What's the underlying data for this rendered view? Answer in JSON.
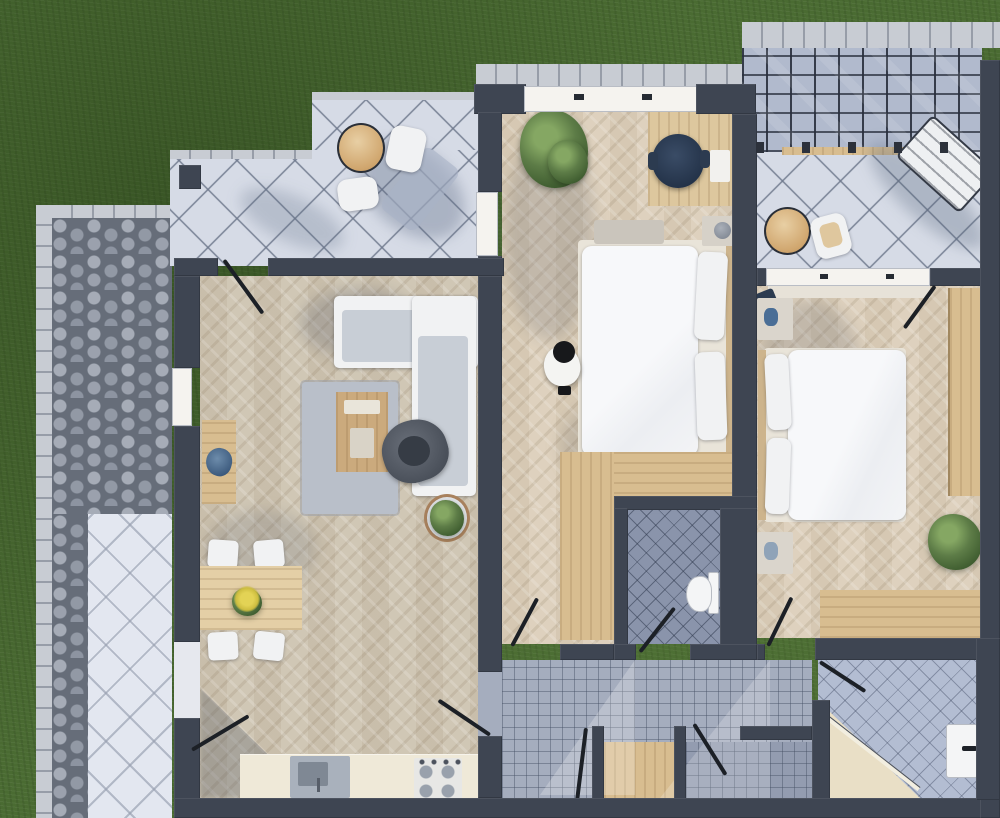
{
  "meta": {
    "description": "3D top-down architectural floor plan rendering of an apartment with garden lawn, paver walkway, three tiled terraces, a pergola canopy and furnished rooms",
    "width_px": 1000,
    "height_px": 818,
    "visible_text": "none"
  },
  "palette": {
    "grass": "#4a6b32",
    "wall": "#3e4552",
    "tile": "#d6dbe6",
    "tileLight": "#e3e7f0",
    "paverBase": "#666d79",
    "curb": "#c8ccd3",
    "woodLiving": "#cec4b1",
    "woodBed": "#dccfba",
    "furnWood": "#d8bd90",
    "cushion": "#c8ced6",
    "rug": "#b9bfc9",
    "hallTile": "#a5adbe",
    "wcTile": "#8a94ab",
    "bathTile": "#b3bdd2",
    "pergolaBg": "#b1bacd",
    "navy": "#2c3b50",
    "accentBlue": "#4a6e96",
    "kitchen": "#efe9d8",
    "windowFill": "#f5f3ef",
    "threshold": "#e6e8ee",
    "leafColor": "#1c2026",
    "flower": "#d9c84a",
    "tanTable": "#d2a86e"
  },
  "scene": {
    "outdoor": [
      {
        "name": "lawn"
      },
      {
        "name": "paver-walkway"
      },
      {
        "name": "curb-edging"
      },
      {
        "name": "southwest-terrace"
      },
      {
        "name": "northwest-terrace"
      },
      {
        "name": "northeast-terrace"
      },
      {
        "name": "pergola-canopy"
      }
    ],
    "rooms": [
      {
        "name": "living-dining-room"
      },
      {
        "name": "kitchen-zone"
      },
      {
        "name": "bedroom-1"
      },
      {
        "name": "bedroom-2"
      },
      {
        "name": "wc"
      },
      {
        "name": "hallway"
      },
      {
        "name": "bathroom"
      },
      {
        "name": "utility-room-a"
      },
      {
        "name": "utility-room-b"
      }
    ],
    "furniture": [
      {
        "name": "outdoor-round-table-nw"
      },
      {
        "name": "outdoor-chairs-nw"
      },
      {
        "name": "outdoor-round-table-ne"
      },
      {
        "name": "outdoor-chair-ne"
      },
      {
        "name": "sun-lounger"
      },
      {
        "name": "l-shaped-sofa"
      },
      {
        "name": "coffee-table"
      },
      {
        "name": "armchair"
      },
      {
        "name": "area-rug"
      },
      {
        "name": "console-desk"
      },
      {
        "name": "potted-plant-living"
      },
      {
        "name": "dining-table"
      },
      {
        "name": "dining-chairs-x4"
      },
      {
        "name": "flower-centerpiece"
      },
      {
        "name": "kitchen-counter"
      },
      {
        "name": "kitchen-sink"
      },
      {
        "name": "cooktop-4-burner"
      },
      {
        "name": "double-bed-bedroom-1"
      },
      {
        "name": "pillows"
      },
      {
        "name": "nightstands"
      },
      {
        "name": "work-desk"
      },
      {
        "name": "office-chair"
      },
      {
        "name": "plant-bedroom-1"
      },
      {
        "name": "l-shaped-wardrobe"
      },
      {
        "name": "person-standing"
      },
      {
        "name": "double-bed-bedroom-2"
      },
      {
        "name": "wardrobe-bedroom-2"
      },
      {
        "name": "dresser-bench"
      },
      {
        "name": "plant-bedroom-2"
      },
      {
        "name": "toilet"
      },
      {
        "name": "bathroom-vanity"
      },
      {
        "name": "corner-shower"
      },
      {
        "name": "interior-door-leaves"
      }
    ]
  }
}
